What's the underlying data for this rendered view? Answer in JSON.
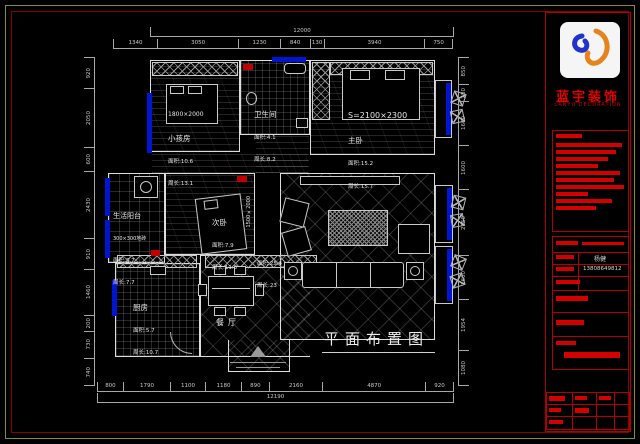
{
  "company": {
    "name": "蓝宇装饰",
    "name_en": "LANYU DECORATION"
  },
  "title_block": {
    "contact_name": "杨健",
    "contact_phone": "13808649812"
  },
  "plan": {
    "title": "平面布置图",
    "rooms": {
      "kids": {
        "bed": "1800×2000",
        "name": "小孩房",
        "area": "面积:10.6",
        "perimeter": "周长:13.1"
      },
      "bath": {
        "name": "卫生间",
        "area": "面积:4.1",
        "perimeter": "周长:8.2"
      },
      "master": {
        "bed": "S=2100×2300",
        "name": "主卧",
        "area": "面积:15.2",
        "perimeter": "周长:15.7"
      },
      "balcony": {
        "name": "生活阳台",
        "tile": "300×300地砖",
        "area": "面积:3.7",
        "perimeter": "周长:7.7"
      },
      "second": {
        "name": "次卧",
        "area": "面积:7.9",
        "perimeter": "周长:11.3",
        "bed": "1500×2000"
      },
      "kitchen": {
        "name": "厨房",
        "area": "面积:5.7",
        "perimeter": "周长:10.7"
      },
      "dining": {
        "name": "餐厅"
      },
      "living": {
        "area": "面积:25.4",
        "perimeter": "周长:23"
      }
    },
    "dims": {
      "top_total": "12000",
      "top": [
        "1340",
        "3050",
        "1230",
        "840",
        "130",
        "3940",
        "750"
      ],
      "bottom": [
        "800",
        "1790",
        "1100",
        "1180",
        "890",
        "2160",
        "4870",
        "920"
      ],
      "bottom_total": "12190",
      "left": [
        "920",
        "2050",
        "600",
        "2430",
        "910",
        "1460",
        "200",
        "730",
        "740"
      ],
      "right": [
        "850",
        "280",
        "1600",
        "1600",
        "2750",
        "1600",
        "1954",
        "1080"
      ]
    }
  }
}
